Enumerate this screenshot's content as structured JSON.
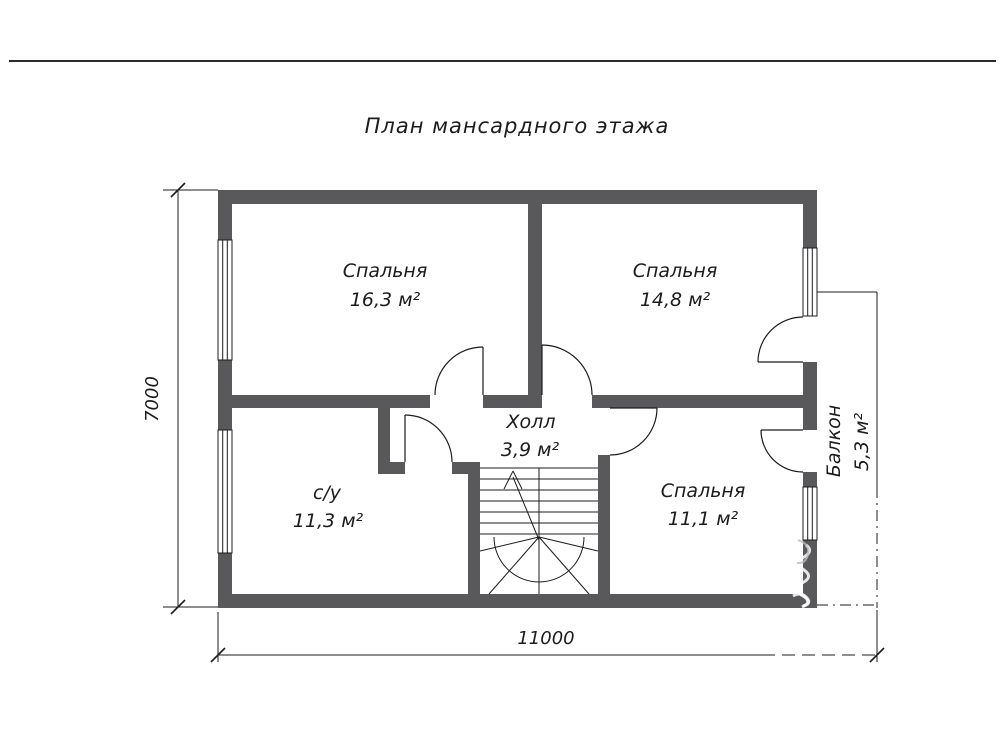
{
  "title": "План мансардного этажа",
  "rooms": {
    "bedroom1": {
      "name": "Спальня",
      "area": "16,3 м²"
    },
    "bedroom2": {
      "name": "Спальня",
      "area": "14,8 м²"
    },
    "hall": {
      "name": "Холл",
      "area": "3,9 м²"
    },
    "bathroom": {
      "name": "с/у",
      "area": "11,3 м²"
    },
    "bedroom3": {
      "name": "Спальня",
      "area": "11,1 м²"
    },
    "balcony": {
      "name": "Балкон",
      "area": "5,3 м²"
    }
  },
  "dimensions": {
    "overall_width": "11000",
    "overall_height": "7000"
  },
  "colors": {
    "wall": "#59595b",
    "line": "#1c1c1e",
    "background": "#ffffff"
  }
}
